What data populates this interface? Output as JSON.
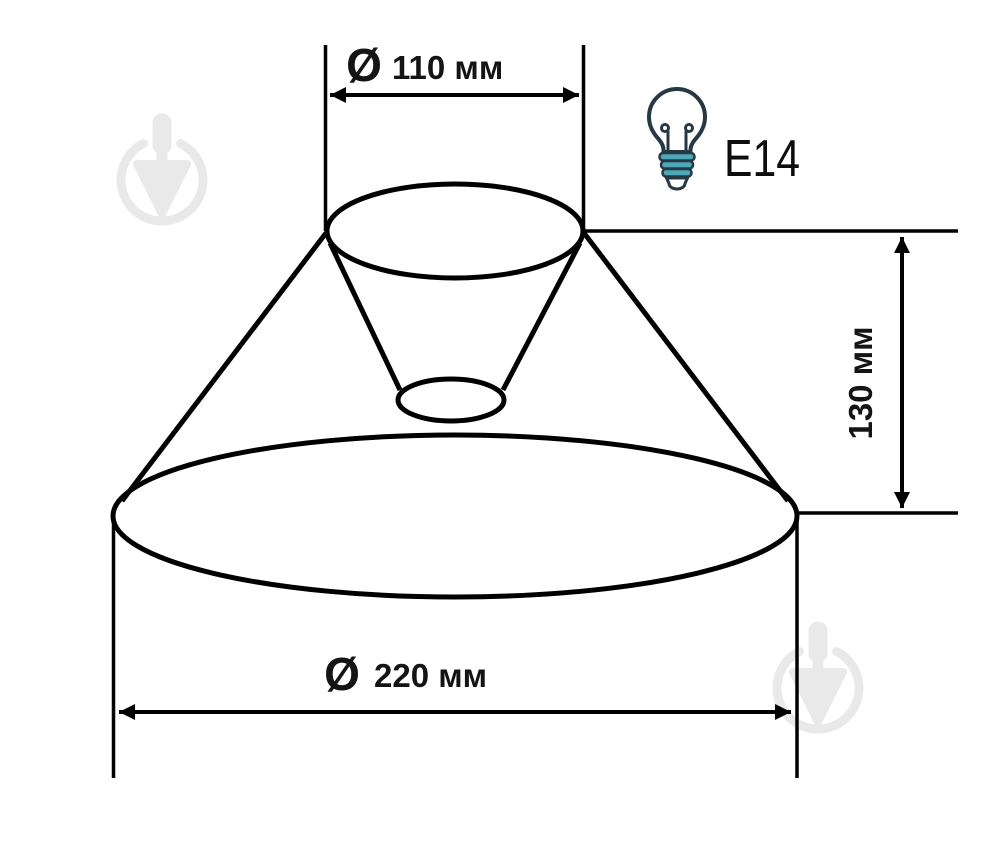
{
  "dimensions": {
    "top_diameter": {
      "symbol": "Ø",
      "value": "110 мм"
    },
    "bottom_diameter": {
      "symbol": "Ø",
      "value": "220 мм"
    },
    "height": {
      "value": "130 мм"
    }
  },
  "socket": {
    "type_label": "E14"
  },
  "icons": {
    "bulb": "light-bulb-icon",
    "watermark": "trowel-circle-watermark"
  },
  "colors": {
    "line": "#000000",
    "text": "#141414",
    "bulb_outline": "#263844",
    "bulb_base_teal": "#4da7b8",
    "watermark_gray": "#e9e9e9",
    "background": "#ffffff"
  }
}
